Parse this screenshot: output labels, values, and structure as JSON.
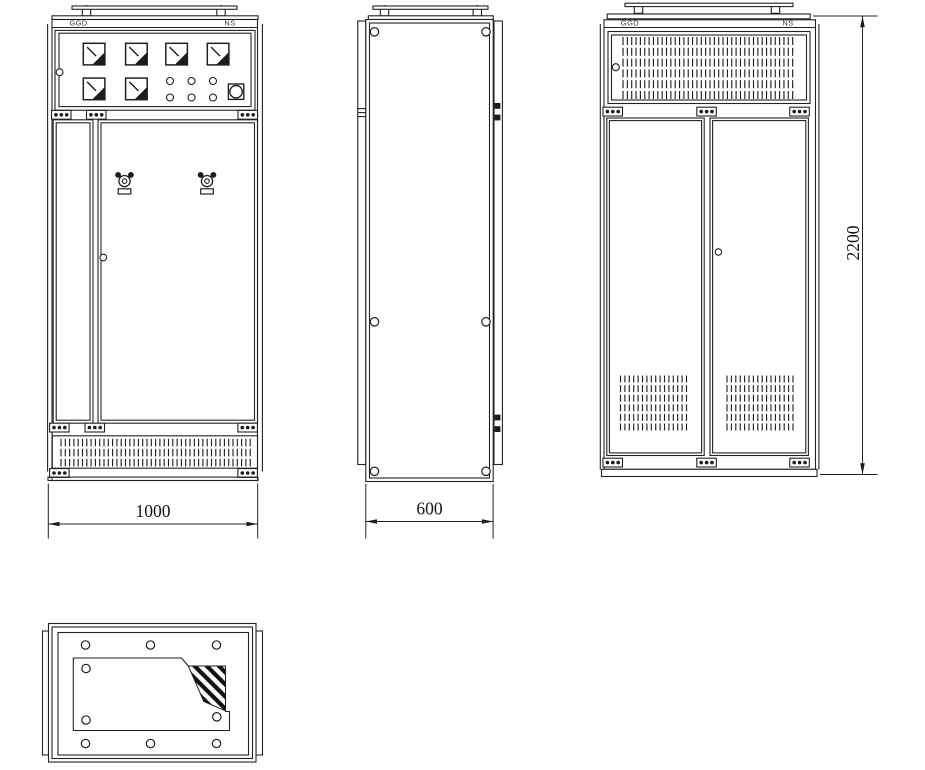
{
  "views": {
    "front": {
      "label_left": "GGD",
      "label_right": "NS",
      "dimension": "1000"
    },
    "side": {
      "dimension": "600"
    },
    "rear": {
      "label_left": "GGD",
      "label_right": "NS",
      "dimension": "2200"
    },
    "bottom": {}
  },
  "colors": {
    "line": "#222222",
    "background": "#ffffff",
    "hazard_stripe": "#111111"
  },
  "icons": {
    "analog_meter": "square-with-needle-and-filled-corner-triangle",
    "indicator_lamp": "small-circle",
    "push_button": "circle-in-square",
    "rotary_handle": "two-lobe-switch-handle-with-plate",
    "lifting_lug": "semicircle-on-square",
    "hinge_strip": "bar-with-three-dots",
    "bolt_hole": "small-circle",
    "vent_grille": "rows-of-vertical-slots",
    "hazard_area": "diagonal-black-stripes",
    "door_lock": "small-circle"
  }
}
